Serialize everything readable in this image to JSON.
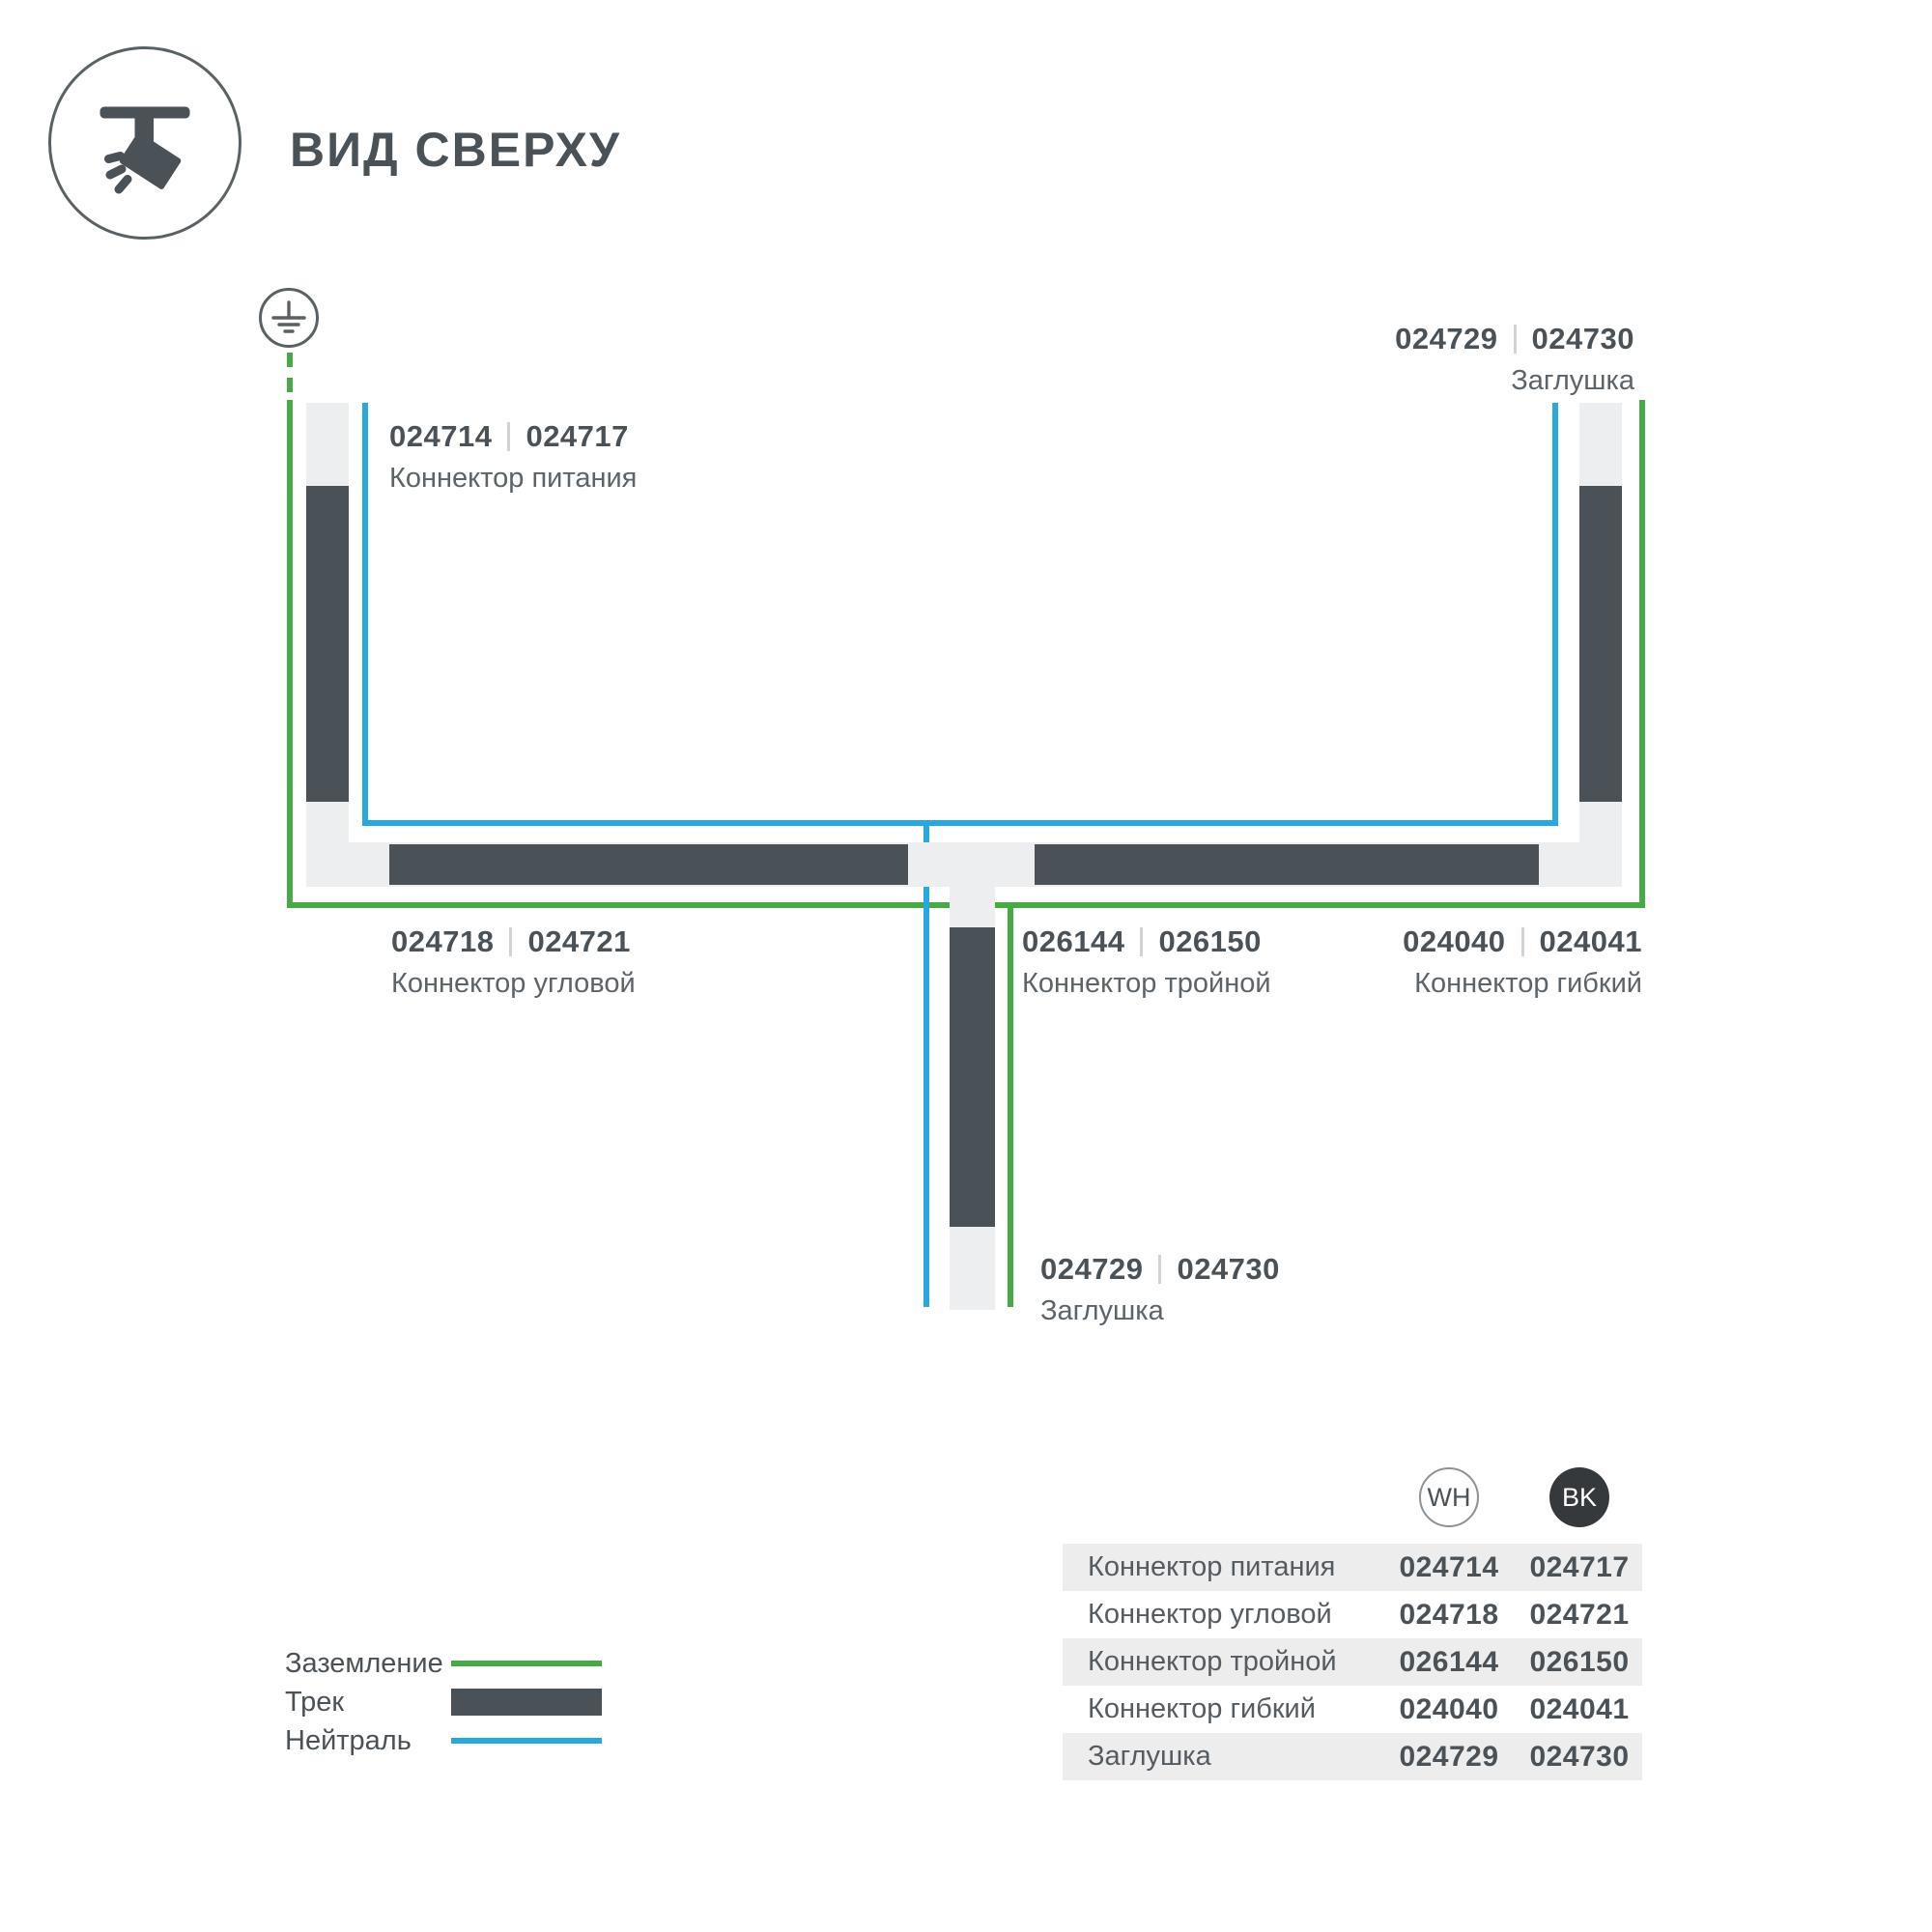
{
  "header": {
    "title": "ВИД СВЕРХУ",
    "icon": "track-spotlight-icon"
  },
  "diagram": {
    "ground_symbol": "earth-ground-icon",
    "labels": [
      {
        "codes": [
          "024714",
          "024717"
        ],
        "name": "Коннектор питания"
      },
      {
        "codes": [
          "024729",
          "024730"
        ],
        "name": "Заглушка"
      },
      {
        "codes": [
          "024718",
          "024721"
        ],
        "name": "Коннектор угловой"
      },
      {
        "codes": [
          "026144",
          "026150"
        ],
        "name": "Коннектор тройной"
      },
      {
        "codes": [
          "024040",
          "024041"
        ],
        "name": "Коннектор гибкий"
      },
      {
        "codes": [
          "024729",
          "024730"
        ],
        "name": "Заглушка"
      }
    ],
    "colors": {
      "ground_wire": "#46ab44",
      "neutral_wire": "#29a8e0",
      "track_fill": "#4a5258",
      "track_body": "#eceeef"
    }
  },
  "legend": {
    "items": [
      {
        "label": "Заземление",
        "swatch": "green-line"
      },
      {
        "label": "Трек",
        "swatch": "dark-bar"
      },
      {
        "label": "Нейтраль",
        "swatch": "blue-line"
      }
    ]
  },
  "table": {
    "columns": [
      {
        "code": "WH"
      },
      {
        "code": "BK"
      }
    ],
    "rows": [
      {
        "name": "Коннектор питания",
        "wh": "024714",
        "bk": "024717"
      },
      {
        "name": "Коннектор угловой",
        "wh": "024718",
        "bk": "024721"
      },
      {
        "name": "Коннектор тройной",
        "wh": "026144",
        "bk": "026150"
      },
      {
        "name": "Коннектор гибкий",
        "wh": "024040",
        "bk": "024041"
      },
      {
        "name": "Заглушка",
        "wh": "024729",
        "bk": "024730"
      }
    ]
  }
}
